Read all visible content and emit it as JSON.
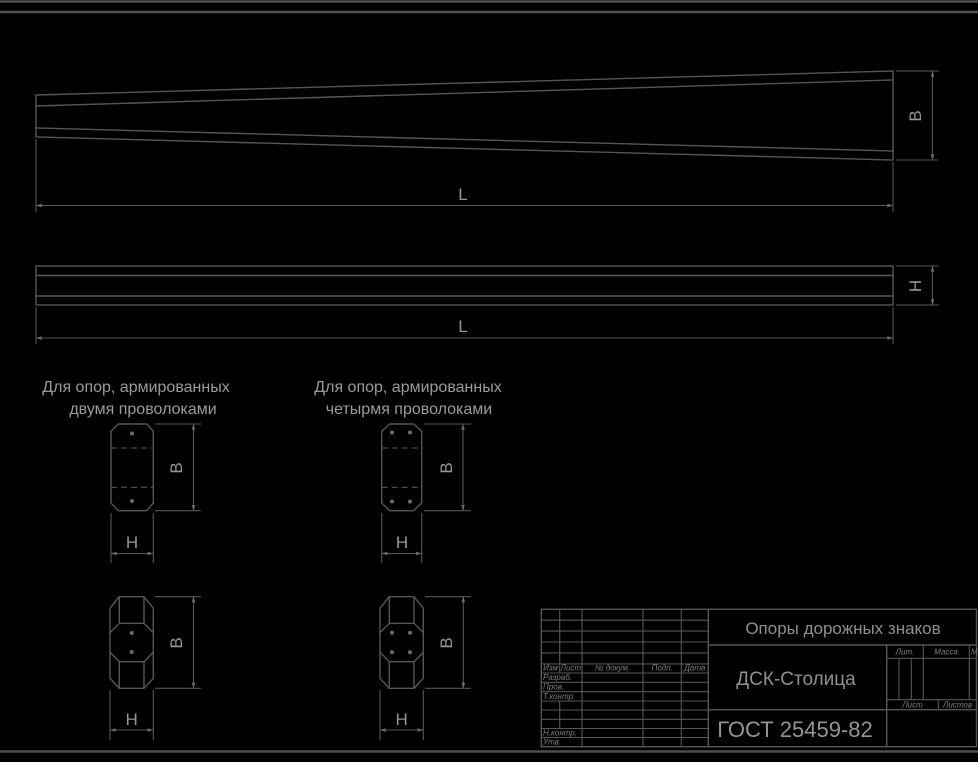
{
  "drawing": {
    "dim_labels": {
      "length": "L",
      "width": "B",
      "height": "H"
    },
    "section_groups": [
      {
        "title_line1": "Для опор, армированных",
        "title_line2": "двумя проволоками"
      },
      {
        "title_line1": "Для опор, армированных",
        "title_line2": "четырмя проволоками"
      }
    ],
    "title_block": {
      "doc_title": "Опоры дорожных знаков",
      "organization": "ДСК-Столица",
      "standard": "ГОСТ 25459-82",
      "revision_header": [
        "Изм",
        "Лист",
        "№ докум.",
        "Подп.",
        "Дата"
      ],
      "signature_rows": [
        "Разраб.",
        "Пров.",
        "Т.контр.",
        "Н.контр.",
        "Утв."
      ],
      "lit_label": "Лит.",
      "mass_label": "Масса",
      "scale_label": "Масштаб",
      "sheet_label": "Лист",
      "sheets_label": "Листов"
    },
    "colors": {
      "background": "#000000",
      "line": "#565656",
      "text": "#8f8f8f"
    }
  }
}
